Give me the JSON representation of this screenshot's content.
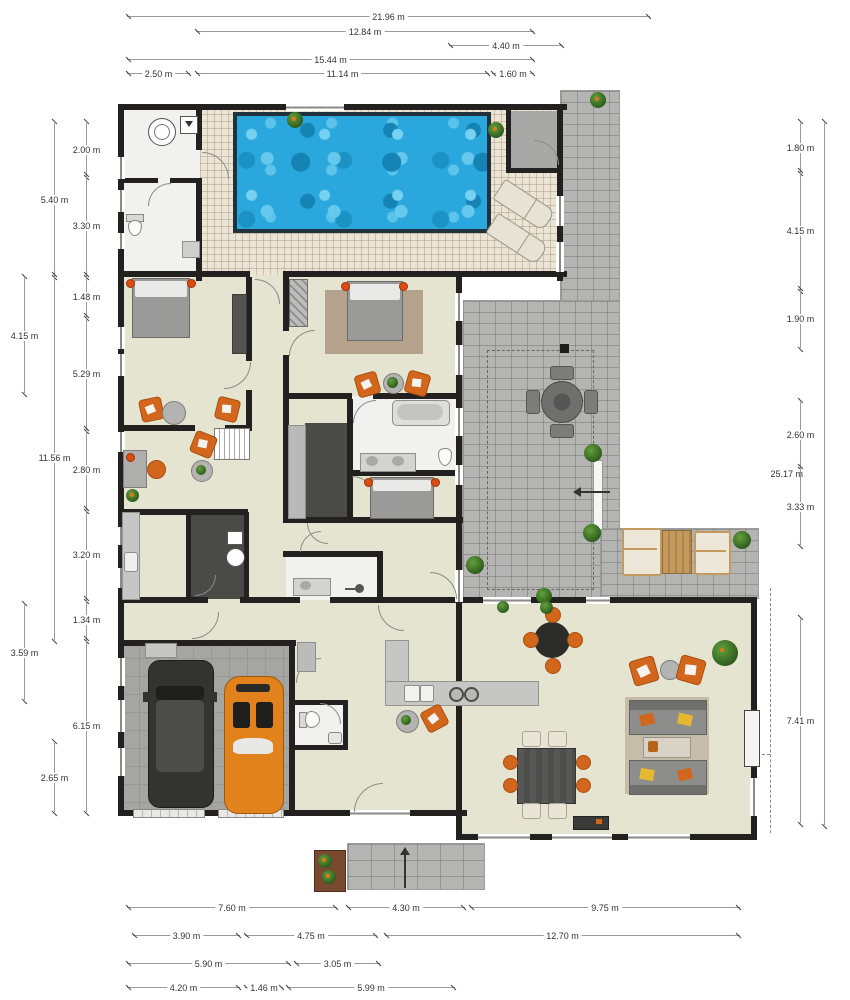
{
  "meta": {
    "type": "floor-plan",
    "units": "m"
  },
  "dims": {
    "top": [
      "21.96 m",
      "12.84 m",
      "4.40 m",
      "15.44 m",
      "2.50 m",
      "11.14 m",
      "1.60 m"
    ],
    "left": [
      "2.00 m",
      "5.40 m",
      "3.30 m",
      "1.48 m",
      "4.15 m",
      "5.29 m",
      "11.56 m",
      "2.80 m",
      "3.20 m",
      "1.34 m",
      "3.59 m",
      "6.15 m",
      "2.65 m"
    ],
    "right": [
      "1.80 m",
      "4.15 m",
      "1.90 m",
      "2.60 m",
      "25.17 m",
      "3.33 m",
      "7.41 m"
    ],
    "bottom": [
      "7.60 m",
      "4.30 m",
      "9.75 m",
      "3.90 m",
      "4.75 m",
      "12.70 m",
      "5.90 m",
      "3.05 m",
      "4.20 m",
      "1.46 m",
      "5.99 m"
    ]
  },
  "colors": {
    "wall": "#22211f",
    "floor_beige": "#e4e4d1",
    "floor_white": "#f1f1f0",
    "deck_tile": "#ece4d4",
    "patio_paver": "#b4b4b2",
    "garage_floor": "#a5a5a3",
    "dark_room": "#4a4a47",
    "pool_water": "#2aa7dc",
    "accent_orange": "#d2661c",
    "rug_brown": "#b5a28c",
    "rug_tan": "#c6bcaa",
    "wood": "#c49a5e",
    "cream": "#e9e4d6",
    "red_dot": "#de4b10"
  },
  "icons": {
    "pool": "blue-water-rect",
    "plant": "green-circle",
    "entrance-arrow": "black-arrow",
    "stairs": "striped-rect",
    "washing-machine": "circle-in-square",
    "stove": "two-burner-circles",
    "sink": "basin-rect",
    "door": "quarter-arc",
    "window": "white-gap-with-line",
    "suv-car": "dark-car-top-view",
    "sports-car": "orange-car-top-view"
  }
}
